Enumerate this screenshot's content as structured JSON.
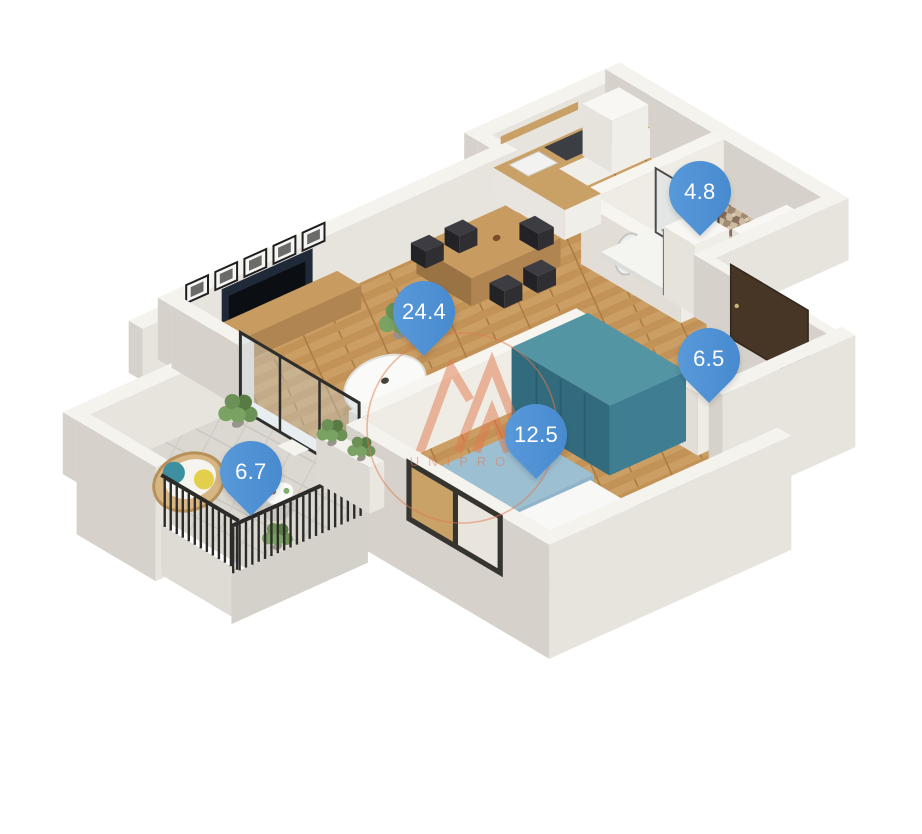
{
  "image": {
    "type": "3d-floor-plan",
    "background": "#ffffff"
  },
  "watermark": {
    "brand": "UNIPRO",
    "accent_color": "#e07a4e"
  },
  "pins": {
    "color": "#4a8ed3",
    "text_color": "#ffffff",
    "items": [
      {
        "room": "bathroom",
        "area_label": "4.8"
      },
      {
        "room": "living-room",
        "area_label": "24.4"
      },
      {
        "room": "hallway",
        "area_label": "6.5"
      },
      {
        "room": "bedroom",
        "area_label": "12.5"
      },
      {
        "room": "balcony",
        "area_label": "6.7"
      }
    ]
  }
}
